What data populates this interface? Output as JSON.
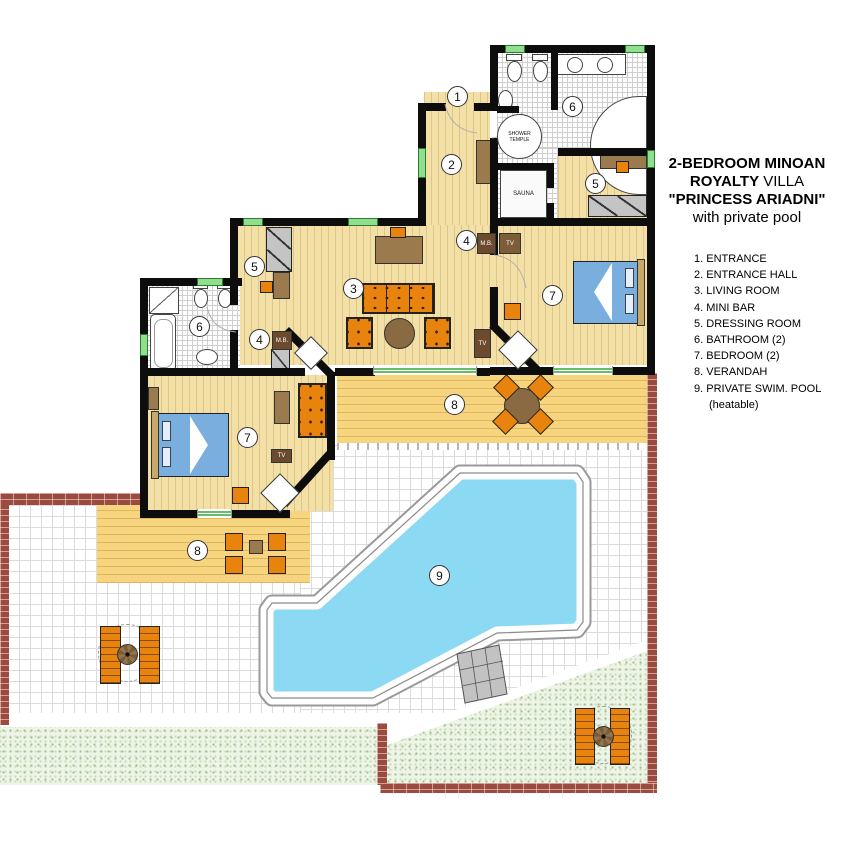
{
  "title": {
    "line1": "2-BEDROOM MINOAN",
    "line2a": "ROYALTY",
    "line2b": " VILLA",
    "line3": "\"PRINCESS ARIADNI\"",
    "line4": "with private pool"
  },
  "legend": {
    "items": [
      {
        "num": "1.",
        "label": "ENTRANCE"
      },
      {
        "num": "2.",
        "label": "ENTRANCE HALL"
      },
      {
        "num": "3.",
        "label": "LIVING ROOM"
      },
      {
        "num": "4.",
        "label": "MINI BAR"
      },
      {
        "num": "5.",
        "label": "DRESSING ROOM"
      },
      {
        "num": "6.",
        "label": "BATHROOM (2)"
      },
      {
        "num": "7.",
        "label": "BEDROOM (2)"
      },
      {
        "num": "8.",
        "label": "VERANDAH"
      },
      {
        "num": "9.",
        "label": "PRIVATE SWIM. POOL",
        "note": "(heatable)"
      }
    ]
  },
  "plan": {
    "numbers": {
      "n1": "1",
      "n2": "2",
      "n3": "3",
      "n4": "4",
      "n5": "5",
      "n6": "6",
      "n7": "7",
      "n8": "8",
      "n9": "9"
    }
  },
  "fixtures": {
    "shower_temple": "SHOWER TEMPLE",
    "sauna": "SAUNA",
    "mini_bar": "M.B.",
    "tv": "TV"
  },
  "colors": {
    "wall": "#0d0d0d",
    "wood_floor": "#f3e0a6",
    "verandah_deck": "#f6d57e",
    "pool_water": "#8bd9f2",
    "grass": "#eef5e8",
    "brick": "#9a4a3e",
    "furniture_orange": "#e8830d",
    "furniture_brown": "#9b7a4e",
    "bed_blue": "#79aede",
    "window_green": "#8fdf8f"
  }
}
